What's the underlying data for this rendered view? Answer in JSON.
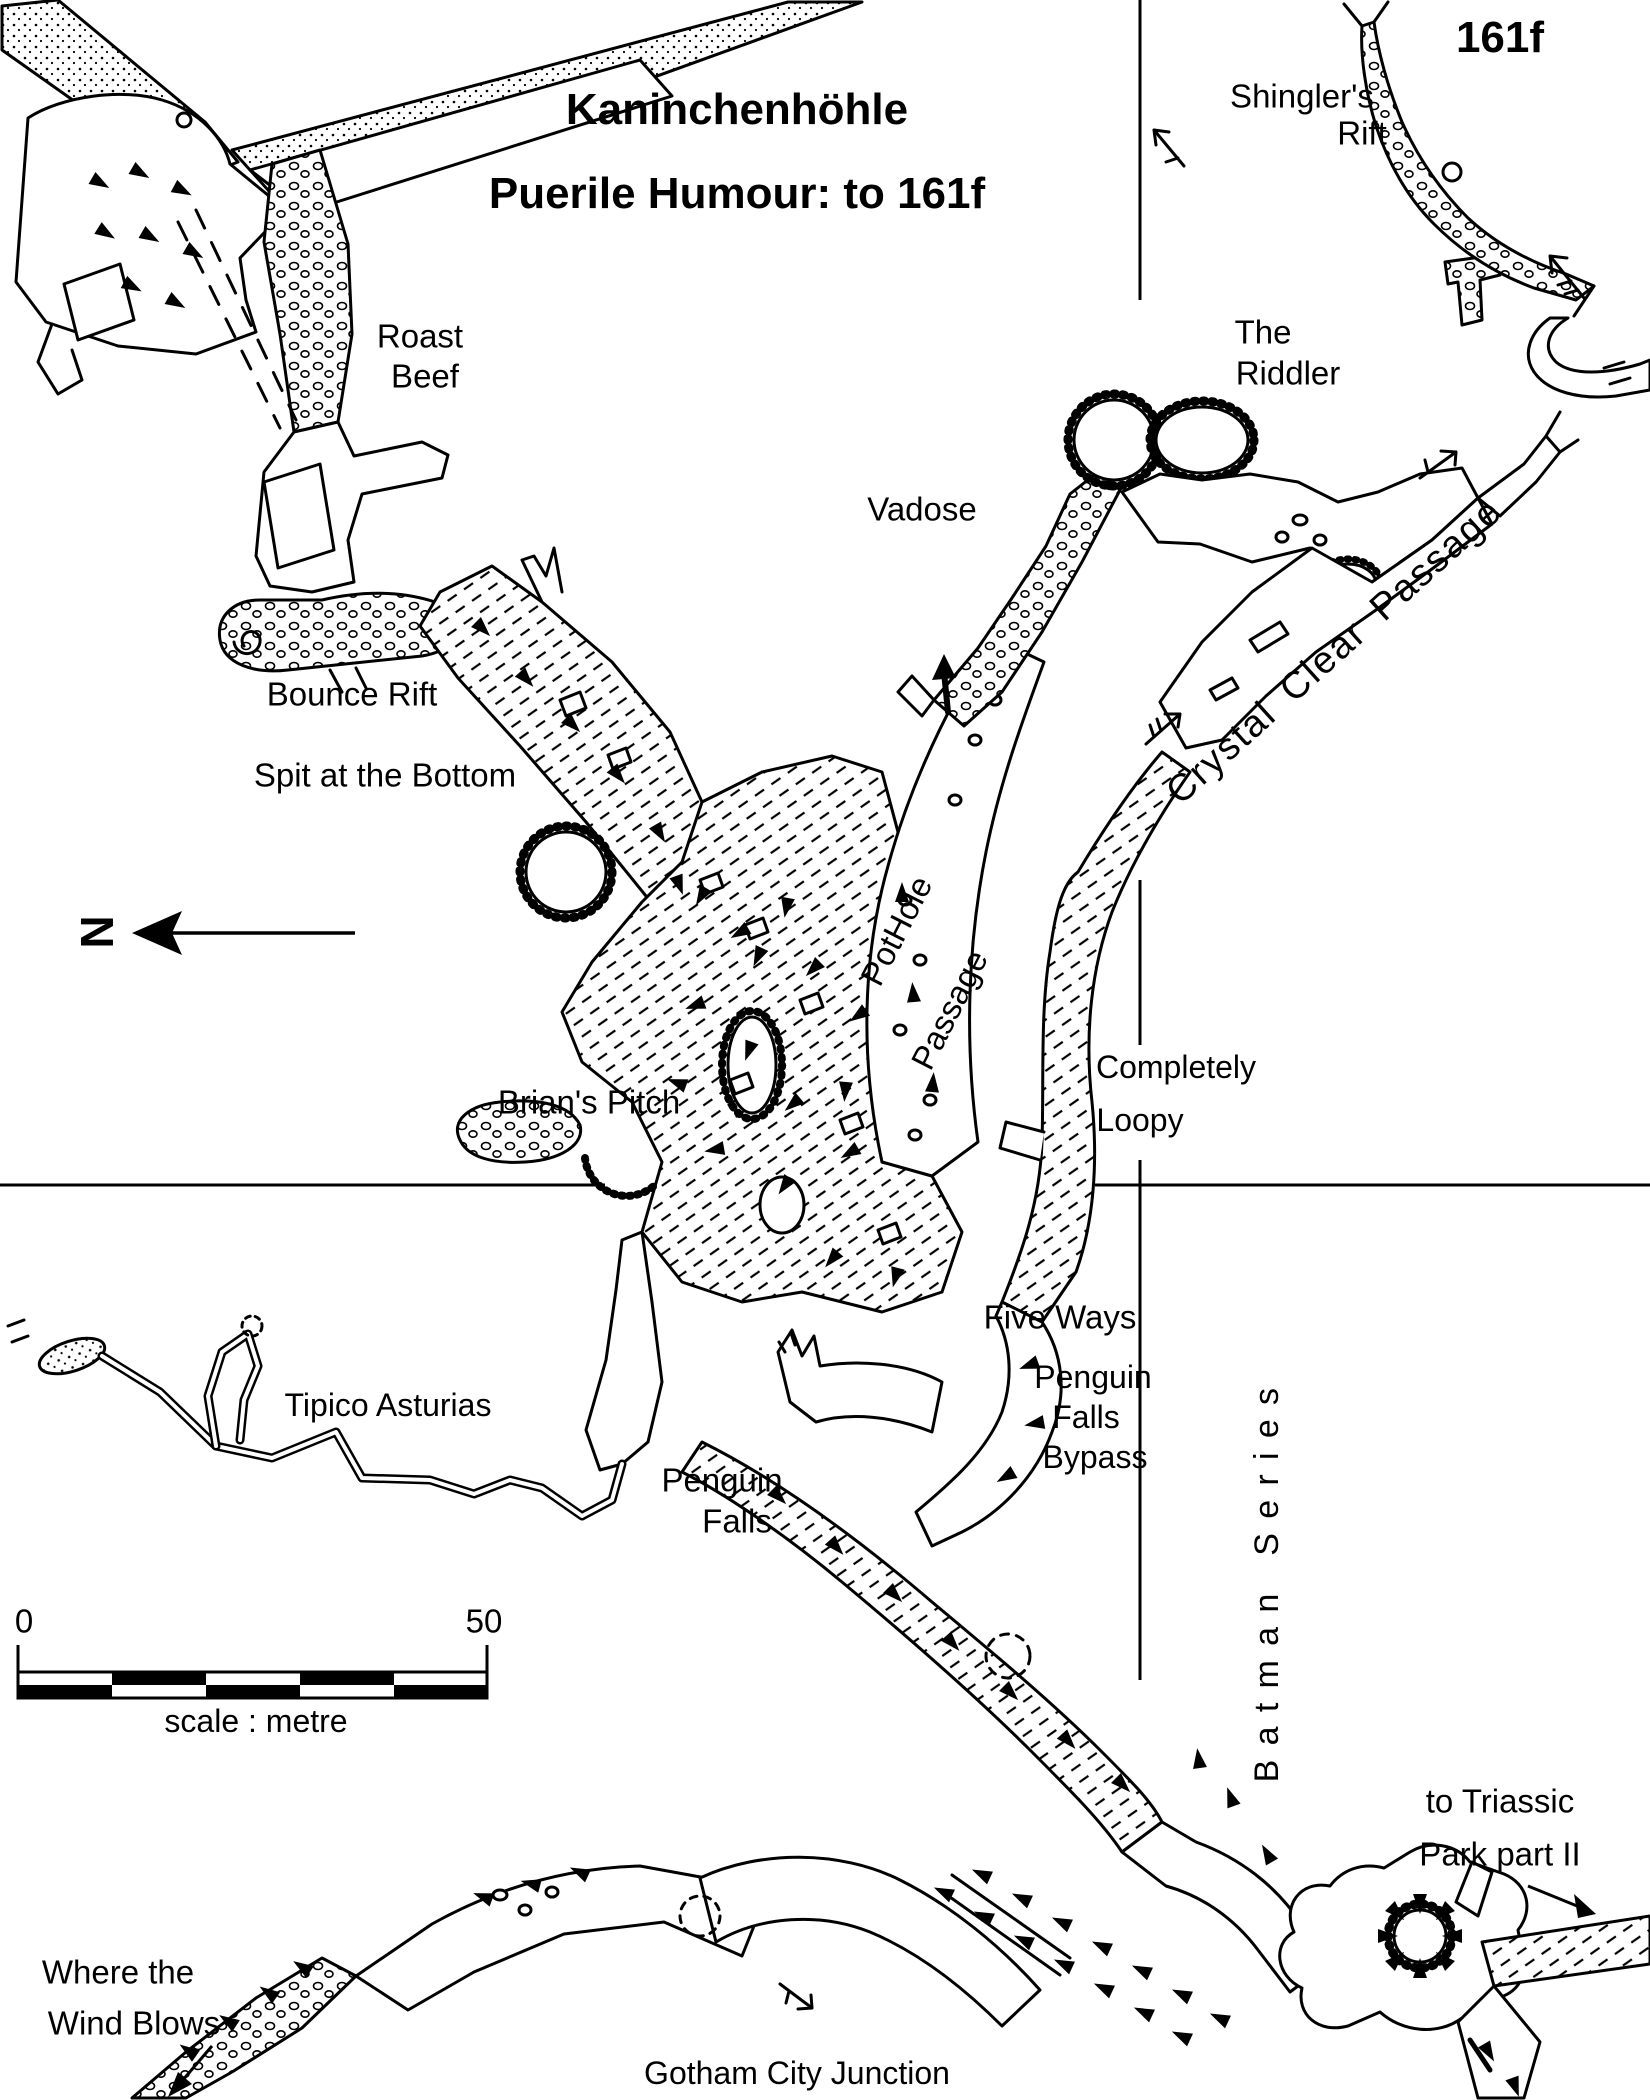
{
  "page": {
    "background": "#ffffff",
    "ink": "#000000"
  },
  "header": {
    "title_line1": "Kaninchenhöhle",
    "title_line2": "Puerile Humour: to 161f",
    "station_label": "161f"
  },
  "north": {
    "letter": "N"
  },
  "scale_bar": {
    "start_label": "0",
    "end_label": "50",
    "caption": "scale : metre",
    "length_metres": 50
  },
  "labels": {
    "roast_beef": {
      "line1": "Roast",
      "line2": "Beef"
    },
    "bounce_rift": {
      "text": "Bounce Rift"
    },
    "spit_at_the_bottom": {
      "text": "Spit at the Bottom"
    },
    "vadose": {
      "text": "Vadose"
    },
    "the_riddler": {
      "line1": "The",
      "line2": "Riddler"
    },
    "shinglers_rift": {
      "line1": "Shingler's",
      "line2": "Rift"
    },
    "crystal_clear_passage": {
      "text": "Crystal Clear Passage"
    },
    "pothole_passage": {
      "line1": "PotHole",
      "line2": "Passage"
    },
    "completely_loopy": {
      "line1": "Completely",
      "line2": "Loopy"
    },
    "brians_pitch": {
      "text": "Brian's Pitch"
    },
    "five_ways": {
      "text": "Five Ways"
    },
    "penguin_falls_bypass": {
      "line1": "Penguin",
      "line2": "Falls",
      "line3": "Bypass"
    },
    "tipico_asturias": {
      "text": "Tipico Asturias"
    },
    "penguin_falls": {
      "line1": "Penguin",
      "line2": "Falls"
    },
    "batman_series": {
      "text": "Batman Series"
    },
    "gotham_city_junction": {
      "text": "Gotham City Junction"
    },
    "where_the_wind_blows": {
      "line1": "Where the",
      "line2": "Wind Blows"
    },
    "to_triassic_park": {
      "line1": "to Triassic",
      "line2": "Park part II"
    }
  },
  "icons": {
    "north_arrow": "left-pointing-north-arrow",
    "draught_arrows": "barbed-airflow-arrows",
    "slope_wedges": "black-slope-tick-triangles",
    "grid": "survey-grid-crosshair-lines",
    "pothole": "radial-fringed-pothole-circle"
  }
}
